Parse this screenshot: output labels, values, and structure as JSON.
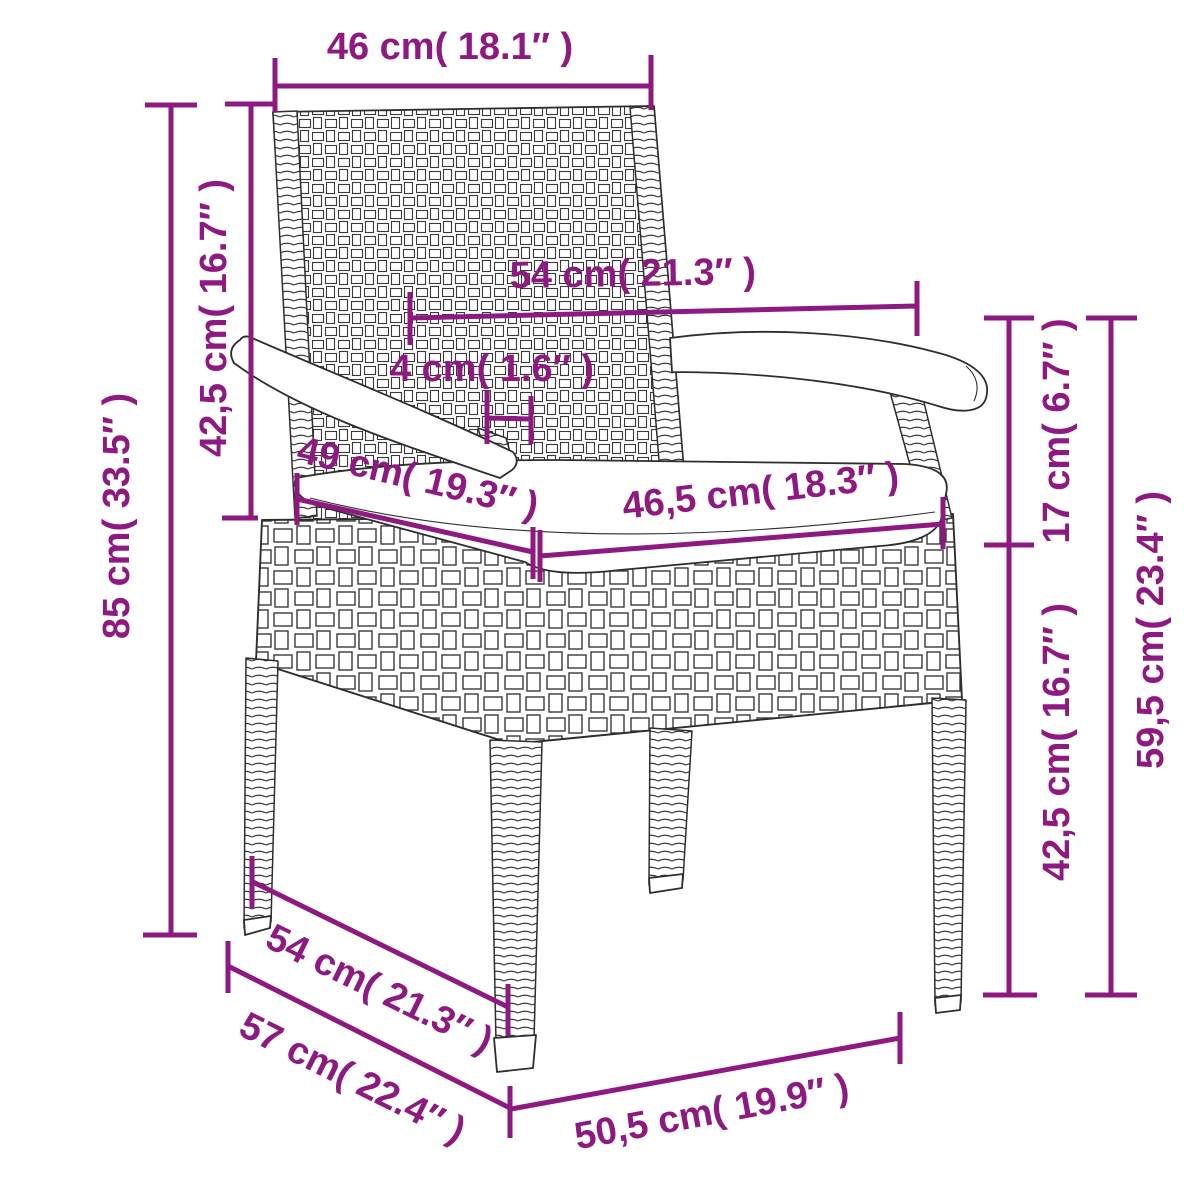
{
  "diagram": {
    "kind": "product-dimension-diagram",
    "subject": "poly-rattan garden chair with seat cushion",
    "accent_color": "#8E1980",
    "line_color": "#2e2e2e",
    "background_color": "#ffffff",
    "dimensions": [
      {
        "id": "backrest-top-width",
        "cm": "46",
        "in": "18.1",
        "label": "46 cm( 18.1″ )"
      },
      {
        "id": "backrest-height-left",
        "cm": "42,5",
        "in": "16.7",
        "label": "42,5 cm( 16.7″ )"
      },
      {
        "id": "total-height-left",
        "cm": "85",
        "in": "33.5",
        "label": "85 cm( 33.5″ )"
      },
      {
        "id": "armrest-span-middle",
        "cm": "54",
        "in": "21.3",
        "label": "54 cm( 21.3″ )"
      },
      {
        "id": "armrest-bar-width",
        "cm": "4",
        "in": "1.6",
        "label": "4 cm( 1.6″ )"
      },
      {
        "id": "seat-depth",
        "cm": "49",
        "in": "19.3",
        "label": "49 cm( 19.3″ )"
      },
      {
        "id": "seat-width",
        "cm": "46,5",
        "in": "18.3",
        "label": "46,5 cm( 18.3″ )"
      },
      {
        "id": "arm-to-seat-right",
        "cm": "17",
        "in": "6.7",
        "label": "17 cm( 6.7″ )"
      },
      {
        "id": "seat-height-right",
        "cm": "42,5",
        "in": "16.7",
        "label": "42,5 cm( 16.7″ )"
      },
      {
        "id": "armrest-height-right",
        "cm": "59,5",
        "in": "23.4",
        "label": "59,5 cm( 23.4″ )"
      },
      {
        "id": "base-depth-upper",
        "cm": "54",
        "in": "21.3",
        "label": "54 cm( 21.3″ )"
      },
      {
        "id": "base-depth-lower",
        "cm": "57",
        "in": "22.4",
        "label": "57 cm( 22.4″ )"
      },
      {
        "id": "front-width-bottom",
        "cm": "50,5",
        "in": "19.9",
        "label": "50,5 cm( 19.9″ )"
      }
    ]
  }
}
